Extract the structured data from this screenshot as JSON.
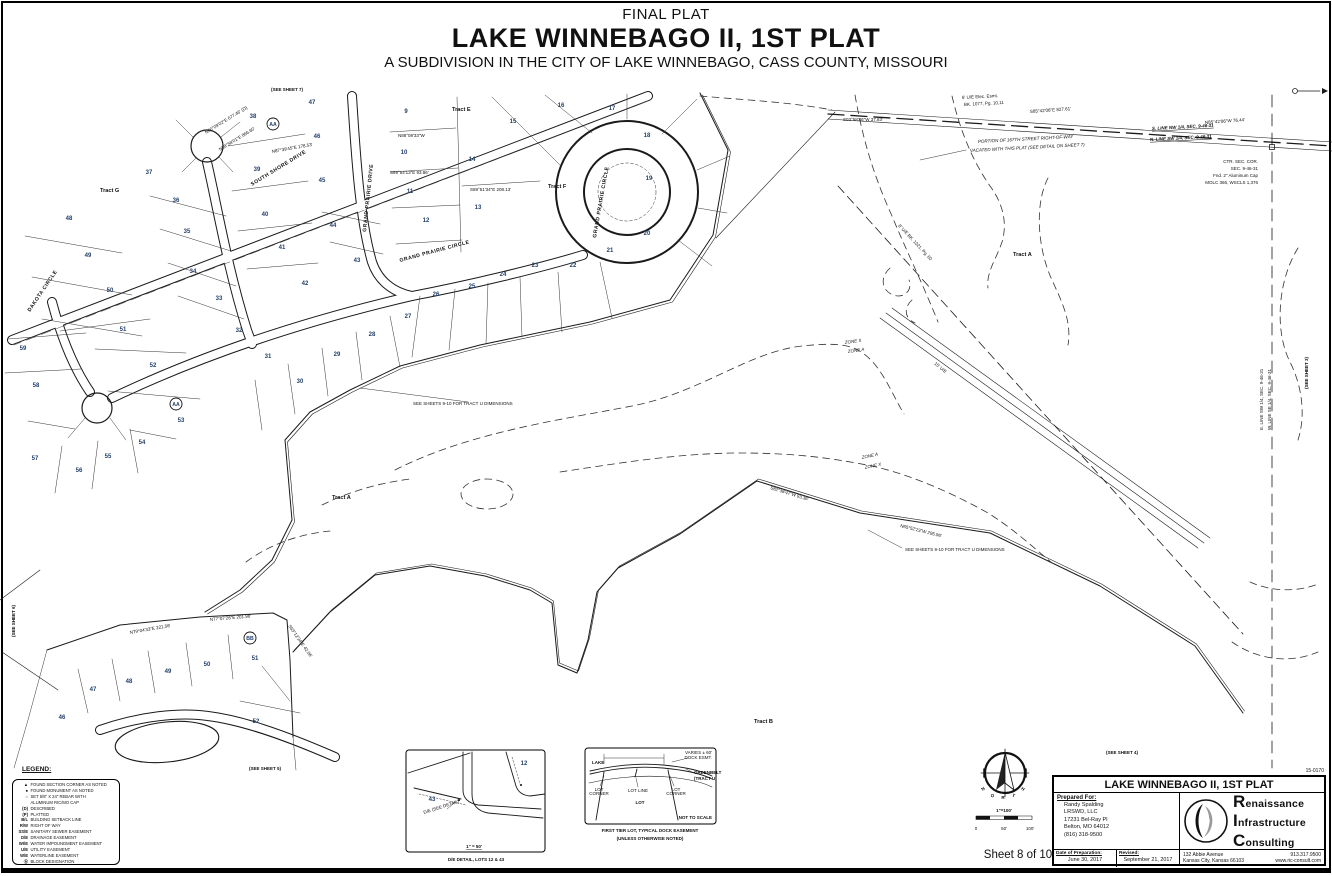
{
  "header": {
    "eyebrow": "FINAL PLAT",
    "title": "LAKE WINNEBAGO II, 1ST PLAT",
    "subtitle": "A SUBDIVISION IN THE CITY OF LAKE WINNEBAGO, CASS COUNTY, MISSOURI"
  },
  "sheet_label": "Sheet 8 of 10",
  "legend": {
    "title": "LEGEND:",
    "items": [
      {
        "sym": "▲",
        "text": "FOUND SECTION CORNER AS NOTED"
      },
      {
        "sym": "●",
        "text": "FOUND MONUMENT AS NOTED"
      },
      {
        "sym": "○",
        "text": "SET 5/8\" X 24\" REBAR WITH",
        "text2": "ALUMINUM RIC/MO CAP"
      },
      {
        "sym": "(D)",
        "text": "DESCRIBED"
      },
      {
        "sym": "(P)",
        "text": "PLATTED"
      },
      {
        "sym": "B/L",
        "text": "BUILDING SETBACK LINE"
      },
      {
        "sym": "R/W",
        "text": "RIGHT OF WAY"
      },
      {
        "sym": "SS/E",
        "text": "SANITARY SEWER EASEMENT"
      },
      {
        "sym": "D/E",
        "text": "DRAINAGE EASEMENT"
      },
      {
        "sym": "WI/E",
        "text": "WATER IMPOUNDMENT EASEMENT"
      },
      {
        "sym": "U/E",
        "text": "UTILITY EASEMENT"
      },
      {
        "sym": "W/E",
        "text": "WATERLINE EASEMENT"
      },
      {
        "sym": "Ⓐ",
        "text": "BLOCK DESIGNATION"
      }
    ]
  },
  "titleblock": {
    "project_no": "15-0170",
    "title": "LAKE WINNEBAGO II, 1ST PLAT",
    "prepared_for_label": "Prepared For:",
    "client": [
      "Randy Spalding",
      "LRSWD, LLC",
      "17231 Bel-Ray Pl",
      "Belton, MO 64012",
      "(816) 318-9500"
    ],
    "date_label": "Date of Preparation:",
    "date": "June 30, 2017",
    "revised_label": "Revised:",
    "revised": "September 21, 2017",
    "firm": {
      "word1": "Renaissance",
      "word2": "Infrastructure",
      "word3": "Consulting",
      "address1": "132 Abbie Avenue",
      "address2": "Kansas City, Kansas 66103",
      "phone": "913.317.9500",
      "web": "www.ric-consult.com"
    }
  },
  "compass": {
    "letters": [
      {
        "t": "N",
        "x": 984,
        "y": 790,
        "r": -40
      },
      {
        "t": "O",
        "x": 993,
        "y": 797,
        "r": -20
      },
      {
        "t": "R",
        "x": 1003,
        "y": 799,
        "r": 0
      },
      {
        "t": "T",
        "x": 1013,
        "y": 797,
        "r": 20
      },
      {
        "t": "H",
        "x": 1022,
        "y": 790,
        "r": 40
      }
    ],
    "scale_text": "1\"=100'",
    "ticks": [
      {
        "t": "0",
        "x": 976,
        "y": 830
      },
      {
        "t": "50'",
        "x": 1004,
        "y": 830
      },
      {
        "t": "100'",
        "x": 1030,
        "y": 830
      }
    ]
  },
  "map": {
    "lots": [
      {
        "t": "9",
        "x": 406,
        "y": 113
      },
      {
        "t": "10",
        "x": 404,
        "y": 154
      },
      {
        "t": "11",
        "x": 410,
        "y": 193
      },
      {
        "t": "12",
        "x": 426,
        "y": 222
      },
      {
        "t": "13",
        "x": 478,
        "y": 209
      },
      {
        "t": "14",
        "x": 472,
        "y": 161
      },
      {
        "t": "15",
        "x": 513,
        "y": 123
      },
      {
        "t": "16",
        "x": 561,
        "y": 107
      },
      {
        "t": "17",
        "x": 612,
        "y": 110
      },
      {
        "t": "18",
        "x": 647,
        "y": 137
      },
      {
        "t": "19",
        "x": 649,
        "y": 180
      },
      {
        "t": "20",
        "x": 647,
        "y": 235
      },
      {
        "t": "21",
        "x": 610,
        "y": 252
      },
      {
        "t": "22",
        "x": 573,
        "y": 267
      },
      {
        "t": "23",
        "x": 535,
        "y": 267
      },
      {
        "t": "24",
        "x": 503,
        "y": 276
      },
      {
        "t": "25",
        "x": 472,
        "y": 288
      },
      {
        "t": "26",
        "x": 436,
        "y": 296
      },
      {
        "t": "27",
        "x": 408,
        "y": 318
      },
      {
        "t": "28",
        "x": 372,
        "y": 336
      },
      {
        "t": "29",
        "x": 337,
        "y": 356
      },
      {
        "t": "30",
        "x": 300,
        "y": 383
      },
      {
        "t": "31",
        "x": 268,
        "y": 358
      },
      {
        "t": "32",
        "x": 239,
        "y": 332
      },
      {
        "t": "33",
        "x": 219,
        "y": 300
      },
      {
        "t": "34",
        "x": 193,
        "y": 273
      },
      {
        "t": "35",
        "x": 187,
        "y": 233
      },
      {
        "t": "36",
        "x": 176,
        "y": 202
      },
      {
        "t": "37",
        "x": 149,
        "y": 174
      },
      {
        "t": "38",
        "x": 253,
        "y": 118
      },
      {
        "t": "39",
        "x": 257,
        "y": 171
      },
      {
        "t": "40",
        "x": 265,
        "y": 216
      },
      {
        "t": "41",
        "x": 282,
        "y": 249
      },
      {
        "t": "42",
        "x": 305,
        "y": 285
      },
      {
        "t": "43",
        "x": 357,
        "y": 262
      },
      {
        "t": "44",
        "x": 333,
        "y": 227
      },
      {
        "t": "45",
        "x": 322,
        "y": 182
      },
      {
        "t": "46",
        "x": 317,
        "y": 138
      },
      {
        "t": "47",
        "x": 312,
        "y": 104
      },
      {
        "t": "48",
        "x": 69,
        "y": 220
      },
      {
        "t": "49",
        "x": 88,
        "y": 257
      },
      {
        "t": "50",
        "x": 110,
        "y": 292
      },
      {
        "t": "51",
        "x": 123,
        "y": 331
      },
      {
        "t": "52",
        "x": 153,
        "y": 367
      },
      {
        "t": "53",
        "x": 181,
        "y": 422
      },
      {
        "t": "54",
        "x": 142,
        "y": 444
      },
      {
        "t": "55",
        "x": 108,
        "y": 458
      },
      {
        "t": "56",
        "x": 79,
        "y": 472
      },
      {
        "t": "57",
        "x": 35,
        "y": 460
      },
      {
        "t": "58",
        "x": 36,
        "y": 387
      },
      {
        "t": "59",
        "x": 23,
        "y": 350
      },
      {
        "t": "46",
        "x": 62,
        "y": 719
      },
      {
        "t": "47",
        "x": 93,
        "y": 691
      },
      {
        "t": "48",
        "x": 129,
        "y": 683
      },
      {
        "t": "49",
        "x": 168,
        "y": 673
      },
      {
        "t": "50",
        "x": 207,
        "y": 666
      },
      {
        "t": "51",
        "x": 255,
        "y": 660
      },
      {
        "t": "52",
        "x": 256,
        "y": 723
      }
    ],
    "blocks": [
      {
        "t": "AA",
        "x": 273,
        "y": 126
      },
      {
        "t": "AA",
        "x": 176,
        "y": 406
      },
      {
        "t": "BB",
        "x": 250,
        "y": 640
      }
    ],
    "tracts": [
      {
        "t": "Tract G",
        "x": 100,
        "y": 192
      },
      {
        "t": "Tract E",
        "x": 452,
        "y": 111
      },
      {
        "t": "Tract F",
        "x": 548,
        "y": 188
      },
      {
        "t": "Tract A",
        "x": 1013,
        "y": 256
      },
      {
        "t": "Tract A",
        "x": 332,
        "y": 499
      },
      {
        "t": "Tract B",
        "x": 754,
        "y": 723
      }
    ],
    "streets": [
      {
        "t": "SOUTH SHORE DRIVE",
        "x": 252,
        "y": 186,
        "r": -31.5
      },
      {
        "t": "GRAND PRAIRIE DRIVE",
        "x": 366,
        "y": 232,
        "r": -84
      },
      {
        "t": "GRAND PRAIRIE CIRCLE",
        "x": 400,
        "y": 262,
        "r": -15
      },
      {
        "t": "GRAND PRAIRIE CIRCLE",
        "x": 596,
        "y": 238,
        "r": -80
      },
      {
        "t": "DAKOTA CIRCLE",
        "x": 30,
        "y": 312,
        "r": -56
      }
    ],
    "notes": [
      {
        "t": "(SEE SHEET 7)",
        "x": 287,
        "y": 91,
        "s": 7,
        "c": "b mid"
      },
      {
        "t": "(SEE SHEET 3)",
        "x": 1308,
        "y": 373,
        "r": -90,
        "s": 7,
        "c": "b mid"
      },
      {
        "t": "(SEE SHEET 6)",
        "x": 15,
        "y": 621,
        "r": -90,
        "s": 7,
        "c": "b mid"
      },
      {
        "t": "(SEE SHEET 5)",
        "x": 265,
        "y": 770,
        "s": 7,
        "c": "b mid"
      },
      {
        "t": "(SEE SHEET 4)",
        "x": 1122,
        "y": 754,
        "s": 7,
        "c": "b mid"
      },
      {
        "t": "S. LINE NW 1/4, SEC. 9-46-31",
        "x": 1152,
        "y": 130,
        "r": -3,
        "s": 5,
        "c": "b i u"
      },
      {
        "t": "N. LINE SW 1/4, SEC. 9-46-31",
        "x": 1150,
        "y": 141,
        "r": -3,
        "s": 5,
        "c": "b i u"
      },
      {
        "t": "PORTION OF 167TH STREET RIGHT-OF-WAY",
        "x": 978,
        "y": 143,
        "r": -3,
        "s": 4.8,
        "c": "i"
      },
      {
        "t": "VACATED WITH THIS PLAT (SEE DETAIL ON SHEET 7)",
        "x": 970,
        "y": 152,
        "r": -3,
        "s": 4.8,
        "c": "i"
      },
      {
        "t": "CTR. SEC. COR.",
        "x": 1258,
        "y": 163,
        "c": "end"
      },
      {
        "t": "SEC. 9-46-31",
        "x": 1258,
        "y": 170,
        "c": "end"
      },
      {
        "t": "Fnd. 2\" Aluminum Cap",
        "x": 1258,
        "y": 177,
        "c": "end"
      },
      {
        "t": "MOLC 366, WSCLS 1,376",
        "x": 1258,
        "y": 184,
        "c": "end"
      },
      {
        "t": "6' U/E Elec. Esmt.",
        "x": 962,
        "y": 99,
        "r": -3
      },
      {
        "t": "BK. 1077, Pg. 10,11",
        "x": 964,
        "y": 106,
        "r": -3
      },
      {
        "t": "ZONE X",
        "x": 845,
        "y": 344,
        "r": -8,
        "c": "i"
      },
      {
        "t": "ZONE A",
        "x": 848,
        "y": 353,
        "r": -8,
        "c": "i"
      },
      {
        "t": "ZONE A",
        "x": 862,
        "y": 459,
        "r": -12,
        "c": "i"
      },
      {
        "t": "ZONE X",
        "x": 865,
        "y": 469,
        "r": -12,
        "c": "i"
      },
      {
        "t": "SEE SHEETS 9-10 FOR TRACT U DIMENSIONS",
        "x": 413,
        "y": 405,
        "s": 4.3
      },
      {
        "t": "SEE SHEETS 9-10 FOR TRACT U DIMENSIONS",
        "x": 905,
        "y": 551,
        "s": 4.3
      },
      {
        "t": "E. LINE SW 1/4, SEC. 9-46-31",
        "x": 1263,
        "y": 430,
        "r": -90,
        "s": 4.3
      },
      {
        "t": "W. LINE SE 1/4, SEC. 9-46-31",
        "x": 1271,
        "y": 430,
        "r": -90,
        "s": 4.3
      },
      {
        "t": "8' U/E BK. 1021, Pg. 60",
        "x": 898,
        "y": 226,
        "r": 47
      },
      {
        "t": "15' U/E",
        "x": 934,
        "y": 364,
        "r": 40
      },
      {
        "t": "N85°42'06\"W 76.44'",
        "x": 1205,
        "y": 124,
        "r": -4,
        "s": 4.2
      },
      {
        "t": "S85°42'06\"E 827.61'",
        "x": 1030,
        "y": 113,
        "r": -4,
        "s": 4.2
      },
      {
        "t": "S03°58'46\"W 37.83'",
        "x": 843,
        "y": 121,
        "s": 4.2
      },
      {
        "t": "N60°09'02\"E 677.46' (D)",
        "x": 206,
        "y": 134,
        "r": -31.5,
        "s": 5
      },
      {
        "t": "N59°58'01\"E 866.60'",
        "x": 220,
        "y": 151,
        "r": -31.5,
        "s": 5.5
      },
      {
        "t": "N88°08'33\"W",
        "x": 398,
        "y": 137,
        "s": 4
      },
      {
        "t": "S89°54'13\"E  93.86'",
        "x": 390,
        "y": 174,
        "s": 4
      },
      {
        "t": "S89°51'34\"E  208.13'",
        "x": 470,
        "y": 191,
        "s": 4
      },
      {
        "t": "N87°39'45\"E 178.53'",
        "x": 272,
        "y": 153,
        "r": -10,
        "s": 4
      },
      {
        "t": "N79°04'33\"E 221.56'",
        "x": 130,
        "y": 634,
        "r": -10,
        "s": 4
      },
      {
        "t": "N77°07'26\"E 201.98'",
        "x": 210,
        "y": 621,
        "r": -5,
        "s": 4
      },
      {
        "t": "S63°12'24\"E 42.06'",
        "x": 288,
        "y": 626,
        "r": 55,
        "s": 4
      },
      {
        "t": "S82°38'47\"W 93.36'",
        "x": 770,
        "y": 489,
        "r": 17,
        "s": 4
      },
      {
        "t": "N65°52'23\"W 295.96'",
        "x": 900,
        "y": 527,
        "r": 14,
        "s": 4
      },
      {
        "t": "LAKE",
        "x": 592,
        "y": 764,
        "s": 5,
        "c": "b"
      },
      {
        "t": "VARIES ± 60'",
        "x": 712,
        "y": 754,
        "s": 3.4,
        "c": "end"
      },
      {
        "t": "DOCK ESMT.",
        "x": 712,
        "y": 759,
        "s": 3.4,
        "c": "end"
      },
      {
        "t": "GREENBELT",
        "x": 694,
        "y": 774,
        "s": 4.2,
        "c": "b"
      },
      {
        "t": "(TRACT U)",
        "x": 694,
        "y": 780,
        "s": 4.2,
        "c": "b"
      },
      {
        "t": "LOT",
        "x": 599,
        "y": 791,
        "s": 3.4,
        "c": "mid"
      },
      {
        "t": "CORNER",
        "x": 599,
        "y": 795,
        "s": 3.4,
        "c": "mid"
      },
      {
        "t": "LOT LINE",
        "x": 638,
        "y": 792,
        "s": 3.4,
        "c": "mid"
      },
      {
        "t": "LOT",
        "x": 676,
        "y": 791,
        "s": 3.4,
        "c": "mid"
      },
      {
        "t": "CORNER",
        "x": 676,
        "y": 795,
        "s": 3.4,
        "c": "mid"
      },
      {
        "t": "LOT",
        "x": 640,
        "y": 804,
        "s": 5,
        "c": "b mid"
      },
      {
        "t": "NOT TO SCALE",
        "x": 712,
        "y": 819,
        "s": 4.6,
        "c": "b end"
      },
      {
        "t": "FIRST TIER LOT, TYPICAL DOCK EASEMENT",
        "x": 650,
        "y": 832,
        "s": 4.8,
        "c": "b mid"
      },
      {
        "t": "(UNLESS OTHERWISE NOTED)",
        "x": 650,
        "y": 840,
        "s": 4.8,
        "c": "b mid"
      },
      {
        "t": "43",
        "x": 432,
        "y": 801,
        "s": 6,
        "c": "lot"
      },
      {
        "t": "12",
        "x": 524,
        "y": 765,
        "s": 5,
        "c": "lot"
      },
      {
        "t": "D/E (SEE DETAIL)",
        "x": 424,
        "y": 814,
        "r": -18,
        "s": 3.6
      },
      {
        "t": "1\" = 50'",
        "x": 474,
        "y": 848,
        "s": 4.6,
        "c": "b u mid"
      },
      {
        "t": "D/E DETAIL, LOTS 12 & 43",
        "x": 476,
        "y": 861,
        "s": 4.8,
        "c": "b mid"
      }
    ]
  }
}
